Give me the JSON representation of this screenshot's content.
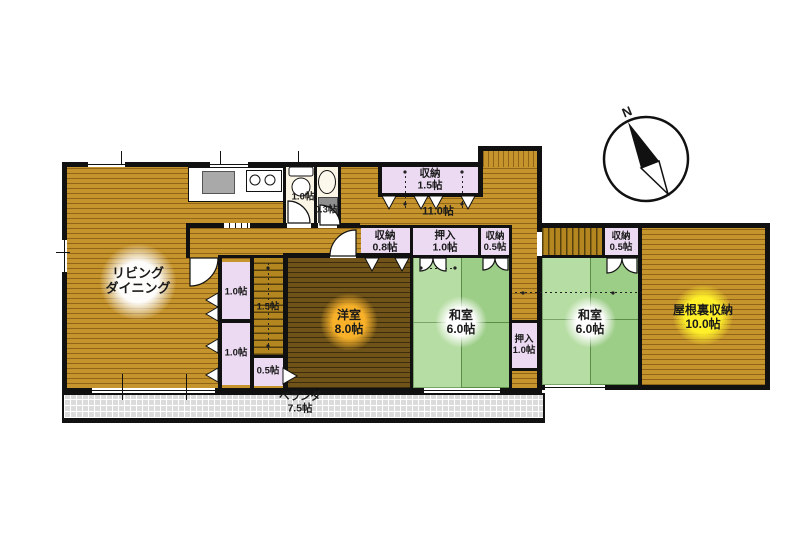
{
  "compass": {
    "north": "N"
  },
  "rooms": {
    "living_dining": {
      "line1": "リビング",
      "line2": "ダイニング"
    },
    "toilet": {
      "size": "1.0帖"
    },
    "washroom": {
      "size": "0.3帖"
    },
    "storage_top": {
      "name": "収納",
      "size": "1.5帖"
    },
    "hall": {
      "size": "11.0帖"
    },
    "storage_08": {
      "name": "収納",
      "size": "0.8帖"
    },
    "oshiire_top": {
      "name": "押入",
      "size": "1.0帖"
    },
    "storage_05_main": {
      "name": "収納",
      "size": "0.5帖"
    },
    "closet_upper": {
      "size": "1.0帖"
    },
    "closet_lower": {
      "size": "1.0帖"
    },
    "stairs": {
      "size": "1.5帖"
    },
    "storage_05_stairs": {
      "size": "0.5帖"
    },
    "western_room": {
      "name": "洋室",
      "size": "8.0帖"
    },
    "japanese_room_1": {
      "name": "和室",
      "size": "6.0帖"
    },
    "oshiire_mid": {
      "name": "押入",
      "size": "1.0帖"
    },
    "japanese_room_2": {
      "name": "和室",
      "size": "6.0帖"
    },
    "storage_05_wing": {
      "name": "収納",
      "size": "0.5帖"
    },
    "attic_storage": {
      "name": "屋根裏収納",
      "size": "10.0帖"
    },
    "veranda": {
      "name": "ベランダ",
      "size": "7.5帖"
    }
  },
  "colors": {
    "wall": "#111111",
    "wood_light": "#C6942C",
    "wood_dark": "#6F5318",
    "tatami_green": "#A8D791",
    "closet_lavender": "#EBDAF2",
    "veranda_gray": "#DBDBDB",
    "highlight_yellow": "#FFF02A",
    "highlight_orange": "#FFB62A",
    "sink_gray": "#A9A9A9"
  }
}
